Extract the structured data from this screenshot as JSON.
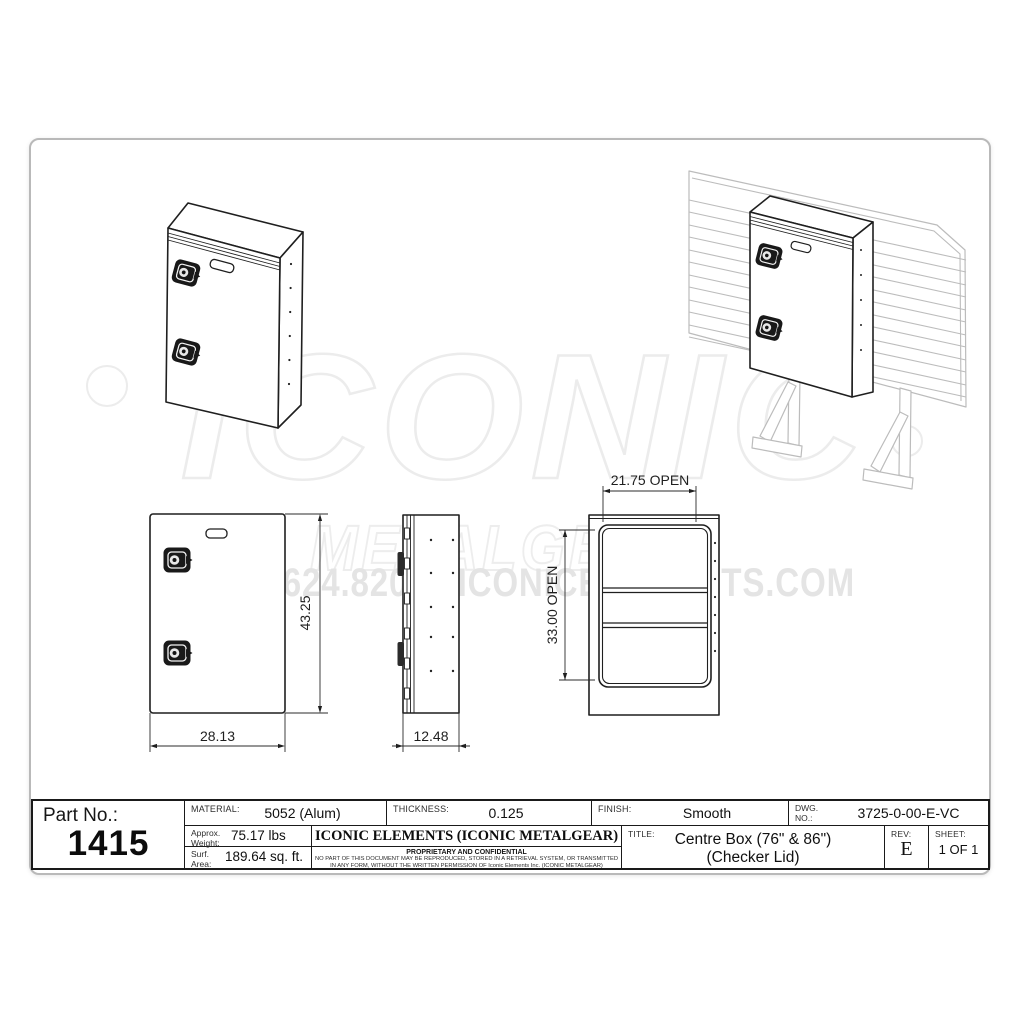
{
  "title_block": {
    "part_no_label": "Part No.:",
    "part_no": "1415",
    "material_label": "MATERIAL:",
    "material_value": "5052 (Alum)",
    "weight_label": "Approx.\nWeight:",
    "weight_value": "75.17 lbs",
    "surf_label": "Surf.\nArea:",
    "surf_value": "189.64 sq. ft.",
    "thickness_label": "THICKNESS:",
    "thickness_value": "0.125",
    "finish_label": "FINISH:",
    "finish_value": "Smooth",
    "dwg_label": "DWG.\nNO.:",
    "dwg_value": "3725-0-00-E-VC",
    "company_name": "ICONIC ELEMENTS (ICONIC METALGEAR)",
    "proprietary_title": "PROPRIETARY AND CONFIDENTIAL",
    "proprietary_body": "NO PART OF THIS DOCUMENT MAY BE REPRODUCED, STORED IN A RETRIEVAL SYSTEM, OR TRANSMITTED\nIN ANY FORM, WITHOUT THE WRITTEN PERMISSION OF Iconic Elements Inc. (ICONIC METALGEAR)",
    "title_label": "TITLE:",
    "title_line1": "Centre Box (76\" & 86\")",
    "title_line2": "(Checker Lid)",
    "rev_label": "REV:",
    "rev_value": "E",
    "sheet_label": "SHEET:",
    "sheet_value": "1 OF 1"
  },
  "dimensions": {
    "front_height": "43.25",
    "front_width": "28.13",
    "side_depth": "12.48",
    "open_width": "21.75 OPEN",
    "open_height": "33.00 OPEN"
  },
  "watermark": {
    "brand": "ICONIC",
    "sub_brand": "METALGEAR",
    "contact": "519.624.8209 | ICONICELEMENTS.COM"
  },
  "colors": {
    "drawing_line": "#1f1f1f",
    "rack_line": "#bcbcbc",
    "watermark": "#ececec"
  }
}
